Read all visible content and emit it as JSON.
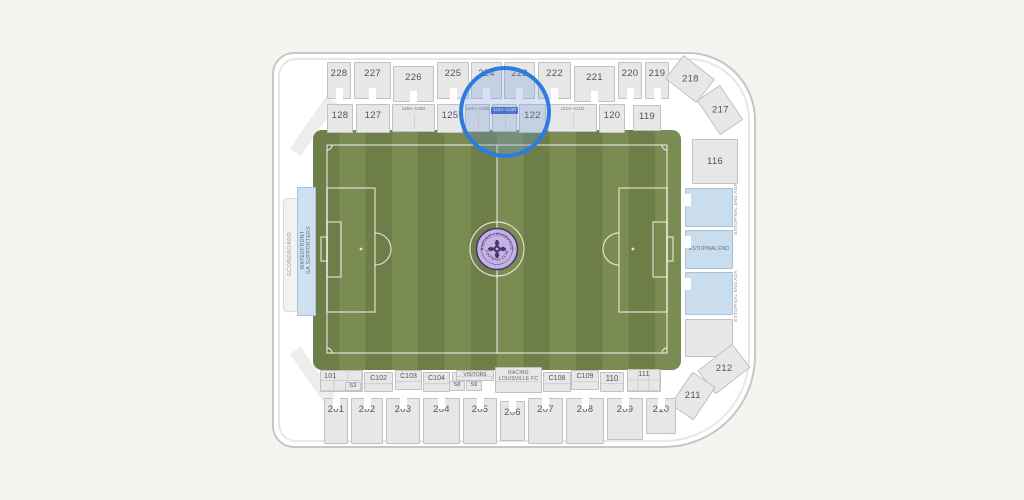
{
  "stadium": {
    "colors": {
      "page_bg": "#f5f4f1",
      "grass_dark": "#6d7e49",
      "grass_light": "#7b8c53",
      "section_fill": "#e7e7e7",
      "blue_section_fill": "#cadded",
      "highlight_blue": "#2e7bdf",
      "selected_label_bg": "#3e68c8",
      "logo_lavender": "#c4b2e2",
      "logo_purple": "#4a3571"
    },
    "logo": {
      "top": "RACING LOUISVILLE",
      "bottom": "FOOTBALL CLUB"
    },
    "labels": {
      "scoreboard": "SCOREBOARD",
      "waterfront_line1": "WATERFRONT",
      "waterfront_line2": "GA SUPPORTERS",
      "estopinal_ada": "ESTOPINAL END ADA",
      "racing_line1": "RACING",
      "racing_line2": "LOUISVILLE FC"
    },
    "highlight": {
      "selected_section": "123A–123B"
    },
    "sections": [
      {
        "label": "228",
        "k": "t",
        "x": 327,
        "y": 62,
        "w": 24,
        "h": 37
      },
      {
        "label": "227",
        "k": "t",
        "x": 354,
        "y": 62,
        "w": 37,
        "h": 37
      },
      {
        "label": "226",
        "k": "t",
        "x": 393,
        "y": 66,
        "w": 41,
        "h": 36
      },
      {
        "label": "225",
        "k": "t",
        "x": 437,
        "y": 62,
        "w": 32,
        "h": 37
      },
      {
        "label": "224",
        "k": "t",
        "x": 471,
        "y": 62,
        "w": 31,
        "h": 37
      },
      {
        "label": "223",
        "k": "t",
        "x": 504,
        "y": 62,
        "w": 31,
        "h": 37
      },
      {
        "label": "222",
        "k": "t",
        "x": 538,
        "y": 62,
        "w": 33,
        "h": 37
      },
      {
        "label": "221",
        "k": "t",
        "x": 574,
        "y": 66,
        "w": 41,
        "h": 36
      },
      {
        "label": "220",
        "k": "t",
        "x": 618,
        "y": 62,
        "w": 24,
        "h": 37
      },
      {
        "label": "219",
        "k": "t",
        "x": 645,
        "y": 62,
        "w": 24,
        "h": 37
      },
      {
        "label": "218",
        "k": "x",
        "x": 670,
        "y": 64,
        "w": 40,
        "h": 30,
        "rot": 38
      },
      {
        "label": "217",
        "k": "x",
        "x": 699,
        "y": 96,
        "w": 42,
        "h": 28,
        "rot": 56
      },
      {
        "label": "128",
        "k": "r",
        "x": 327,
        "y": 104,
        "w": 26,
        "h": 29
      },
      {
        "label": "127",
        "k": "r",
        "x": 356,
        "y": 104,
        "w": 34,
        "h": 29
      },
      {
        "label": "126A–126D",
        "k": "s",
        "x": 392,
        "y": 104,
        "w": 43,
        "h": 28
      },
      {
        "label": "125",
        "k": "r",
        "x": 437,
        "y": 104,
        "w": 26,
        "h": 29
      },
      {
        "label": "124A–124B",
        "k": "s",
        "x": 465,
        "y": 104,
        "w": 25,
        "h": 28
      },
      {
        "label": "123A–123B",
        "k": "ss",
        "x": 492,
        "y": 104,
        "w": 25,
        "h": 28
      },
      {
        "label": "122",
        "k": "r",
        "x": 519,
        "y": 104,
        "w": 27,
        "h": 29
      },
      {
        "label": "121A–121D",
        "k": "s",
        "x": 548,
        "y": 104,
        "w": 49,
        "h": 28
      },
      {
        "label": "120",
        "k": "r",
        "x": 599,
        "y": 104,
        "w": 26,
        "h": 29
      },
      {
        "label": "119",
        "k": "r",
        "x": 633,
        "y": 105,
        "w": 28,
        "h": 26
      },
      {
        "label": "116",
        "k": "p",
        "x": 692,
        "y": 139,
        "w": 46,
        "h": 45
      },
      {
        "label": "",
        "k": "bl",
        "x": 685,
        "y": 188,
        "w": 48,
        "h": 39
      },
      {
        "label": "ESTOPINAL END",
        "k": "bl",
        "x": 685,
        "y": 230,
        "w": 48,
        "h": 39
      },
      {
        "label": "",
        "k": "bl",
        "x": 685,
        "y": 272,
        "w": 48,
        "h": 43
      },
      {
        "label": "",
        "k": "p",
        "x": 685,
        "y": 319,
        "w": 48,
        "h": 38
      },
      {
        "label": "212",
        "k": "x",
        "x": 702,
        "y": 354,
        "w": 44,
        "h": 30,
        "rot": -38
      },
      {
        "label": "211",
        "k": "x",
        "x": 673,
        "y": 382,
        "w": 40,
        "h": 28,
        "rot": -56
      },
      {
        "label": "101",
        "k": "g",
        "x": 320,
        "y": 370,
        "w": 43,
        "h": 22,
        "la": "tl"
      },
      {
        "label": "S3",
        "k": "m",
        "x": 345,
        "y": 382,
        "w": 16,
        "h": 9
      },
      {
        "label": "C102",
        "k": "c",
        "x": 364,
        "y": 372,
        "w": 29,
        "h": 20
      },
      {
        "label": "C103",
        "k": "c",
        "x": 395,
        "y": 370,
        "w": 27,
        "h": 20
      },
      {
        "label": "C104",
        "k": "c",
        "x": 423,
        "y": 372,
        "w": 27,
        "h": 20
      },
      {
        "label": "",
        "k": "c",
        "x": 452,
        "y": 372,
        "w": 12,
        "h": 19
      },
      {
        "label": "VISITORS",
        "k": "c",
        "x": 456,
        "y": 370,
        "w": 38,
        "h": 11,
        "fs": 5
      },
      {
        "label": "S8",
        "k": "m",
        "x": 449,
        "y": 381,
        "w": 16,
        "h": 10
      },
      {
        "label": "S9",
        "k": "m",
        "x": 466,
        "y": 381,
        "w": 16,
        "h": 10
      },
      {
        "label": "C108",
        "k": "c",
        "x": 543,
        "y": 372,
        "w": 28,
        "h": 20
      },
      {
        "label": "C109",
        "k": "c",
        "x": 571,
        "y": 370,
        "w": 28,
        "h": 20
      },
      {
        "label": "110",
        "k": "c",
        "x": 600,
        "y": 372,
        "w": 24,
        "h": 20,
        "fs": 8
      },
      {
        "label": "111",
        "k": "g",
        "x": 627,
        "y": 369,
        "w": 34,
        "h": 23
      },
      {
        "label": "201",
        "k": "b",
        "x": 324,
        "y": 398,
        "w": 24,
        "h": 46
      },
      {
        "label": "202",
        "k": "b",
        "x": 351,
        "y": 398,
        "w": 32,
        "h": 46
      },
      {
        "label": "203",
        "k": "b",
        "x": 386,
        "y": 398,
        "w": 34,
        "h": 46
      },
      {
        "label": "204",
        "k": "b",
        "x": 423,
        "y": 398,
        "w": 37,
        "h": 46
      },
      {
        "label": "205",
        "k": "b",
        "x": 463,
        "y": 398,
        "w": 34,
        "h": 46
      },
      {
        "label": "206",
        "k": "b",
        "x": 500,
        "y": 401,
        "w": 25,
        "h": 40
      },
      {
        "label": "207",
        "k": "b",
        "x": 528,
        "y": 398,
        "w": 35,
        "h": 46
      },
      {
        "label": "208",
        "k": "b",
        "x": 566,
        "y": 398,
        "w": 38,
        "h": 46
      },
      {
        "label": "209",
        "k": "b",
        "x": 607,
        "y": 398,
        "w": 36,
        "h": 42
      },
      {
        "label": "210",
        "k": "b",
        "x": 646,
        "y": 398,
        "w": 30,
        "h": 36
      }
    ]
  }
}
